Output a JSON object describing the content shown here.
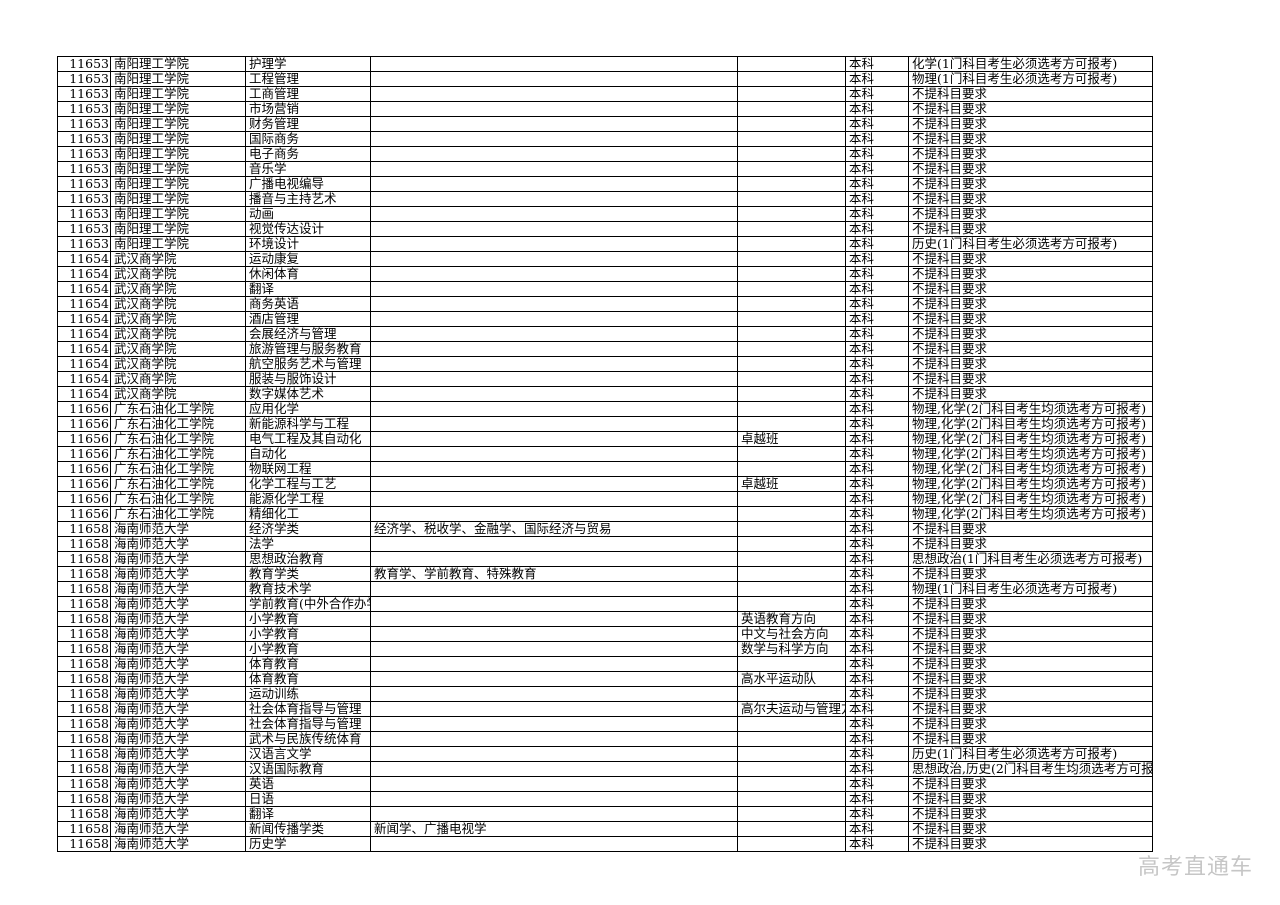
{
  "table": {
    "column_keys": [
      "code",
      "university",
      "major",
      "included_majors",
      "note",
      "level",
      "subject_requirement"
    ],
    "rows": [
      [
        "11653",
        "南阳理工学院",
        "护理学",
        "",
        "",
        "本科",
        "化学(1门科目考生必须选考方可报考)"
      ],
      [
        "11653",
        "南阳理工学院",
        "工程管理",
        "",
        "",
        "本科",
        "物理(1门科目考生必须选考方可报考)"
      ],
      [
        "11653",
        "南阳理工学院",
        "工商管理",
        "",
        "",
        "本科",
        "不提科目要求"
      ],
      [
        "11653",
        "南阳理工学院",
        "市场营销",
        "",
        "",
        "本科",
        "不提科目要求"
      ],
      [
        "11653",
        "南阳理工学院",
        "财务管理",
        "",
        "",
        "本科",
        "不提科目要求"
      ],
      [
        "11653",
        "南阳理工学院",
        "国际商务",
        "",
        "",
        "本科",
        "不提科目要求"
      ],
      [
        "11653",
        "南阳理工学院",
        "电子商务",
        "",
        "",
        "本科",
        "不提科目要求"
      ],
      [
        "11653",
        "南阳理工学院",
        "音乐学",
        "",
        "",
        "本科",
        "不提科目要求"
      ],
      [
        "11653",
        "南阳理工学院",
        "广播电视编导",
        "",
        "",
        "本科",
        "不提科目要求"
      ],
      [
        "11653",
        "南阳理工学院",
        "播音与主持艺术",
        "",
        "",
        "本科",
        "不提科目要求"
      ],
      [
        "11653",
        "南阳理工学院",
        "动画",
        "",
        "",
        "本科",
        "不提科目要求"
      ],
      [
        "11653",
        "南阳理工学院",
        "视觉传达设计",
        "",
        "",
        "本科",
        "不提科目要求"
      ],
      [
        "11653",
        "南阳理工学院",
        "环境设计",
        "",
        "",
        "本科",
        "历史(1门科目考生必须选考方可报考)"
      ],
      [
        "11654",
        "武汉商学院",
        "运动康复",
        "",
        "",
        "本科",
        "不提科目要求"
      ],
      [
        "11654",
        "武汉商学院",
        "休闲体育",
        "",
        "",
        "本科",
        "不提科目要求"
      ],
      [
        "11654",
        "武汉商学院",
        "翻译",
        "",
        "",
        "本科",
        "不提科目要求"
      ],
      [
        "11654",
        "武汉商学院",
        "商务英语",
        "",
        "",
        "本科",
        "不提科目要求"
      ],
      [
        "11654",
        "武汉商学院",
        "酒店管理",
        "",
        "",
        "本科",
        "不提科目要求"
      ],
      [
        "11654",
        "武汉商学院",
        "会展经济与管理",
        "",
        "",
        "本科",
        "不提科目要求"
      ],
      [
        "11654",
        "武汉商学院",
        "旅游管理与服务教育",
        "",
        "",
        "本科",
        "不提科目要求"
      ],
      [
        "11654",
        "武汉商学院",
        "航空服务艺术与管理",
        "",
        "",
        "本科",
        "不提科目要求"
      ],
      [
        "11654",
        "武汉商学院",
        "服装与服饰设计",
        "",
        "",
        "本科",
        "不提科目要求"
      ],
      [
        "11654",
        "武汉商学院",
        "数字媒体艺术",
        "",
        "",
        "本科",
        "不提科目要求"
      ],
      [
        "11656",
        "广东石油化工学院",
        "应用化学",
        "",
        "",
        "本科",
        "物理,化学(2门科目考生均须选考方可报考)"
      ],
      [
        "11656",
        "广东石油化工学院",
        "新能源科学与工程",
        "",
        "",
        "本科",
        "物理,化学(2门科目考生均须选考方可报考)"
      ],
      [
        "11656",
        "广东石油化工学院",
        "电气工程及其自动化",
        "",
        "卓越班",
        "本科",
        "物理,化学(2门科目考生均须选考方可报考)"
      ],
      [
        "11656",
        "广东石油化工学院",
        "自动化",
        "",
        "",
        "本科",
        "物理,化学(2门科目考生均须选考方可报考)"
      ],
      [
        "11656",
        "广东石油化工学院",
        "物联网工程",
        "",
        "",
        "本科",
        "物理,化学(2门科目考生均须选考方可报考)"
      ],
      [
        "11656",
        "广东石油化工学院",
        "化学工程与工艺",
        "",
        "卓越班",
        "本科",
        "物理,化学(2门科目考生均须选考方可报考)"
      ],
      [
        "11656",
        "广东石油化工学院",
        "能源化学工程",
        "",
        "",
        "本科",
        "物理,化学(2门科目考生均须选考方可报考)"
      ],
      [
        "11656",
        "广东石油化工学院",
        "精细化工",
        "",
        "",
        "本科",
        "物理,化学(2门科目考生均须选考方可报考)"
      ],
      [
        "11658",
        "海南师范大学",
        "经济学类",
        "经济学、税收学、金融学、国际经济与贸易",
        "",
        "本科",
        "不提科目要求"
      ],
      [
        "11658",
        "海南师范大学",
        "法学",
        "",
        "",
        "本科",
        "不提科目要求"
      ],
      [
        "11658",
        "海南师范大学",
        "思想政治教育",
        "",
        "",
        "本科",
        "思想政治(1门科目考生必须选考方可报考)"
      ],
      [
        "11658",
        "海南师范大学",
        "教育学类",
        "教育学、学前教育、特殊教育",
        "",
        "本科",
        "不提科目要求"
      ],
      [
        "11658",
        "海南师范大学",
        "教育技术学",
        "",
        "",
        "本科",
        "物理(1门科目考生必须选考方可报考)"
      ],
      [
        "11658",
        "海南师范大学",
        "学前教育(中外合作办学)",
        "",
        "",
        "本科",
        "不提科目要求"
      ],
      [
        "11658",
        "海南师范大学",
        "小学教育",
        "",
        "英语教育方向",
        "本科",
        "不提科目要求"
      ],
      [
        "11658",
        "海南师范大学",
        "小学教育",
        "",
        "中文与社会方向",
        "本科",
        "不提科目要求"
      ],
      [
        "11658",
        "海南师范大学",
        "小学教育",
        "",
        "数学与科学方向",
        "本科",
        "不提科目要求"
      ],
      [
        "11658",
        "海南师范大学",
        "体育教育",
        "",
        "",
        "本科",
        "不提科目要求"
      ],
      [
        "11658",
        "海南师范大学",
        "体育教育",
        "",
        "高水平运动队",
        "本科",
        "不提科目要求"
      ],
      [
        "11658",
        "海南师范大学",
        "运动训练",
        "",
        "",
        "本科",
        "不提科目要求"
      ],
      [
        "11658",
        "海南师范大学",
        "社会体育指导与管理",
        "",
        "高尔夫运动与管理方向",
        "本科",
        "不提科目要求"
      ],
      [
        "11658",
        "海南师范大学",
        "社会体育指导与管理",
        "",
        "",
        "本科",
        "不提科目要求"
      ],
      [
        "11658",
        "海南师范大学",
        "武术与民族传统体育",
        "",
        "",
        "本科",
        "不提科目要求"
      ],
      [
        "11658",
        "海南师范大学",
        "汉语言文学",
        "",
        "",
        "本科",
        "历史(1门科目考生必须选考方可报考)"
      ],
      [
        "11658",
        "海南师范大学",
        "汉语国际教育",
        "",
        "",
        "本科",
        "思想政治,历史(2门科目考生均须选考方可报考)"
      ],
      [
        "11658",
        "海南师范大学",
        "英语",
        "",
        "",
        "本科",
        "不提科目要求"
      ],
      [
        "11658",
        "海南师范大学",
        "日语",
        "",
        "",
        "本科",
        "不提科目要求"
      ],
      [
        "11658",
        "海南师范大学",
        "翻译",
        "",
        "",
        "本科",
        "不提科目要求"
      ],
      [
        "11658",
        "海南师范大学",
        "新闻传播学类",
        "新闻学、广播电视学",
        "",
        "本科",
        "不提科目要求"
      ],
      [
        "11658",
        "海南师范大学",
        "历史学",
        "",
        "",
        "本科",
        "不提科目要求"
      ]
    ]
  },
  "watermark": {
    "text": "高考直通车",
    "color": "#c6c6c6"
  },
  "colors": {
    "background": "#ffffff",
    "grid": "#000000",
    "text": "#000000"
  }
}
